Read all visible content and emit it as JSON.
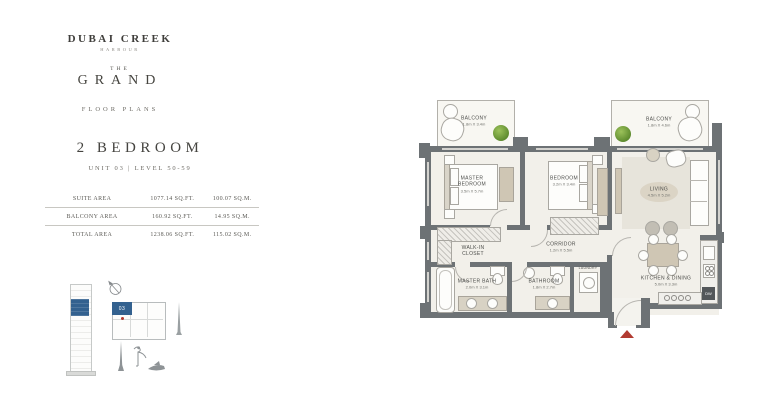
{
  "brand": {
    "name_line1": "DUBAI CREEK",
    "name_line2": "HARBOUR",
    "collection_pre": "THE",
    "collection": "GRAND",
    "doc_type": "FLOOR PLANS"
  },
  "heading": {
    "title": "2 BEDROOM",
    "subtitle": "UNIT 03 | LEVEL 50-59"
  },
  "area_table": {
    "rows": [
      {
        "label": "SUITE AREA",
        "sqft": "1077.14 SQ.FT.",
        "sqm": "100.07 SQ.M."
      },
      {
        "label": "BALCONY AREA",
        "sqft": "160.92 SQ.FT.",
        "sqm": "14.95 SQ.M."
      },
      {
        "label": "TOTAL AREA",
        "sqft": "1238.06 SQ.FT.",
        "sqm": "115.02 SQ.M."
      }
    ]
  },
  "keyplan": {
    "unit": "03"
  },
  "plan": {
    "rooms": [
      {
        "name": "BALCONY",
        "dims": "1.8m X 3.4m"
      },
      {
        "name": "BALCONY",
        "dims": "1.8m X 4.6m"
      },
      {
        "name": "MASTER BEDROOM",
        "dims": "3.5m X 5.7m"
      },
      {
        "name": "BEDROOM",
        "dims": "3.2m X 3.4m"
      },
      {
        "name": "LIVING",
        "dims": "4.5m X 5.2m"
      },
      {
        "name": "WALK-IN CLOSET",
        "dims": ""
      },
      {
        "name": "CORRIDOR",
        "dims": "1.2m X 5.5m"
      },
      {
        "name": "MASTER BATH",
        "dims": "2.0m X 3.1m"
      },
      {
        "name": "BATHROOM",
        "dims": "1.8m X 2.7m"
      },
      {
        "name": "LAUNDRY",
        "dims": ""
      },
      {
        "name": "KITCHEN & DINING",
        "dims": "5.0m X 3.3m"
      }
    ],
    "appliance_labels": {
      "dishwasher": "DW"
    }
  },
  "colors": {
    "wall": "#6d7275",
    "floor": "#f2f0ea",
    "accent_blue": "#33618f",
    "entry_marker_red": "#b23b31",
    "furniture_tan": "#cfc6b4",
    "plant_green": "#76a23f"
  }
}
